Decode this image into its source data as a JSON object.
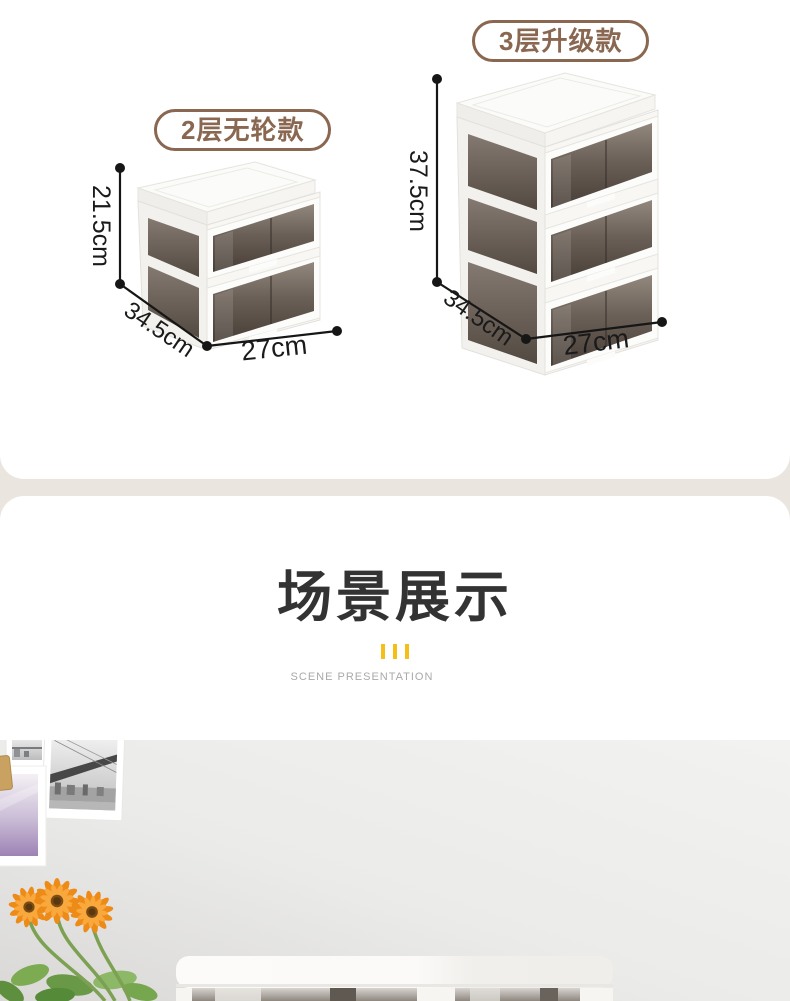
{
  "size_section": {
    "products": [
      {
        "badge": "2层无轮款",
        "height": "21.5cm",
        "depth": "34.5cm",
        "width": "27cm",
        "tiers": "2"
      },
      {
        "badge": "3层升级款",
        "height": "37.5cm",
        "depth": "34.5cm",
        "width": "27cm",
        "tiers": "3"
      }
    ]
  },
  "scene_section": {
    "title": "场景展示",
    "subtitle": "SCENE PRESENTATION"
  },
  "colors": {
    "page_background": "#EAE6DF",
    "card_background": "#FFFFFF",
    "badge_brown": "#8A6750",
    "accent_yellow": "#F5BE18",
    "title_color": "#333333",
    "dimension_color": "#1A1A1A",
    "flower_orange": "#EE8A16"
  }
}
